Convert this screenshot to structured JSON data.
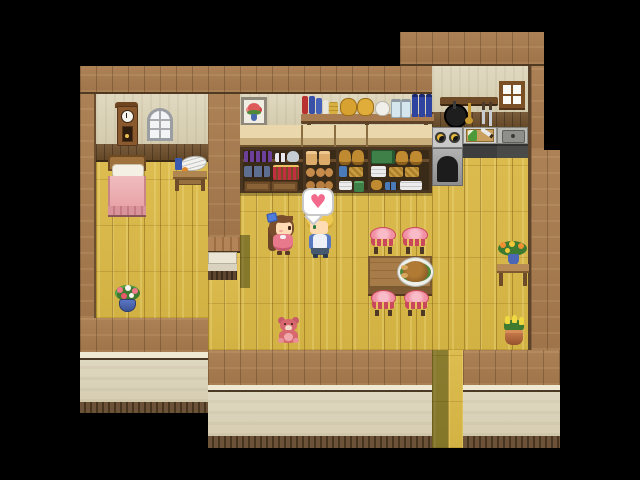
{
  "scene": {
    "genre": "top-down RPG cottage interior",
    "background_color": "#000000",
    "rooms": [
      "bedroom",
      "shop-kitchen main room"
    ],
    "exit": "door passage at bottom center"
  },
  "palette": {
    "wall_wood": "#A5794D",
    "interior_wall": "#DAD3B9",
    "wainscot": "#6F5436",
    "floor": "#D6B647",
    "wall_face": "#DBD4BA",
    "baseboard": "#5E4931",
    "heart_pink": "#F2698C",
    "stool_pink": "#F291A5",
    "blanket_pink": "#ECA8AC"
  },
  "bubble": {
    "type": "speech-balloon-emote",
    "heart_glyph": "♥",
    "color": "#F2698C"
  },
  "characters": [
    {
      "id": "girl",
      "label": "girl with long brown hair, blue bow and pink dress",
      "facing": "right"
    },
    {
      "id": "villager",
      "label": "blonde villager in white and blue outfit",
      "facing": "left",
      "emote": "heart"
    }
  ],
  "objects": {
    "clock": {
      "label": "grandfather wall clock"
    },
    "arched_window": {
      "label": "arched window"
    },
    "bed": {
      "label": "bed with pink blanket and white pillow"
    },
    "washstand": {
      "label": "side table with white basin, blue cloth and orange"
    },
    "picture": {
      "label": "framed picture of red flowers in blue vase"
    },
    "wall_shelf": {
      "label": "wall shelf with books, coin sacks, teapot, jars and blue bottles"
    },
    "cabinets": {
      "label": "shop cabinets stocked with goods"
    },
    "stove": {
      "label": "iron stove with two burners"
    },
    "kitchen_counter": {
      "label": "counter with cutting board, leek and knife"
    },
    "sink": {
      "label": "stone sink"
    },
    "utensil_rack": {
      "label": "wall rack with frying pan, ladle and knives"
    },
    "square_window": {
      "label": "small square window"
    },
    "dining_table": {
      "label": "wooden dining table"
    },
    "turkey": {
      "label": "roast bird on platter with garnish"
    },
    "stool": {
      "label": "pink cushioned stool",
      "count": 4
    },
    "teddy": {
      "label": "pink teddy bear"
    },
    "flower_pot": {
      "label": "blue pot with pink flowers"
    },
    "side_table": {
      "label": "small table with vase of orange flowers"
    },
    "tulip_pot": {
      "label": "clay pot with yellow tulips"
    },
    "step": {
      "label": "small step between rooms"
    },
    "door_passage": {
      "label": "exit passage"
    }
  },
  "shelf_items": [
    "red book",
    "blue books",
    "white book",
    "yellow stacked books",
    "coin sack",
    "coin sack",
    "white teapot",
    "glass jar",
    "glass jar",
    "blue bottle",
    "blue bottle",
    "blue bottle"
  ],
  "cabinet_contents": [
    [
      "purple goblets",
      "salt shakers",
      "silver kettle",
      "blue pots",
      "red bottle rack",
      "two drawers"
    ],
    [
      "bread loaves",
      "round buns",
      "round rolls"
    ],
    [
      "brass pots",
      "blue jar",
      "basket",
      "white towels",
      "green tin"
    ],
    [
      "green crates",
      "brass pots",
      "white towels",
      "baskets",
      "blue cups",
      "linens"
    ]
  ]
}
